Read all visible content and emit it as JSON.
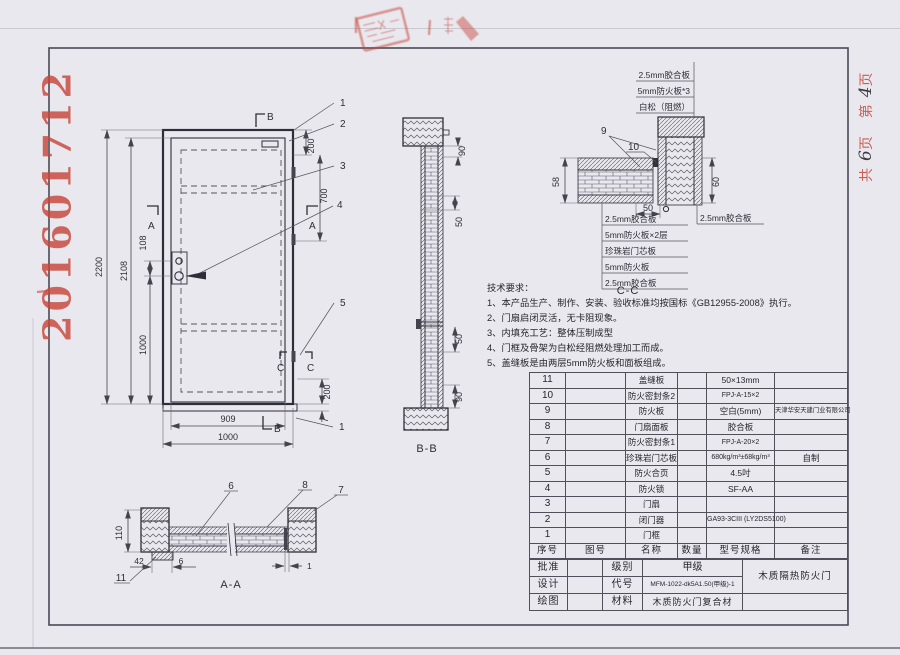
{
  "page": {
    "doc_number": "201601712",
    "sheet_note": {
      "c1": "共",
      "n1": "6",
      "c2": "页",
      "c3": "第",
      "n2": "4",
      "c4": "页"
    }
  },
  "colors": {
    "stamp_red": "#c8473a",
    "line": "#3f3f4a",
    "paper": "#e9e8ee"
  },
  "front_view": {
    "dims": {
      "total_height": "2200",
      "leaf_height": "2108",
      "lock_spacing": "108",
      "lock_to_bottom": "1000",
      "head": "200",
      "upper_side": "700",
      "lower_side": "200",
      "sill": "7",
      "leaf_width": "909",
      "frame_width": "1000",
      "edge_gap": "1"
    },
    "callouts": {
      "n1": "1",
      "n2": "2",
      "n3": "3",
      "n4": "4",
      "n5": "5"
    },
    "markers": {
      "a": "A",
      "b": "B",
      "c": "C"
    }
  },
  "section_bb": {
    "label": "B-B",
    "dims": {
      "head": "90",
      "upper": "50",
      "lower": "50",
      "bottom": "90"
    }
  },
  "detail_cc": {
    "label": "C-C",
    "dims": {
      "leaf_thickness": "58",
      "frame_thickness": "60",
      "overlap": "50"
    },
    "callouts": {
      "n9": "9",
      "n10": "10"
    },
    "top_labels": [
      "2.5mm胶合板",
      "5mm防火板*3",
      "白松（阻燃）"
    ],
    "layer_labels": [
      "2.5mm胶合板",
      "5mm防火板×2层",
      "珍珠岩门芯板",
      "5mm防火板",
      "2.5mm胶合板"
    ],
    "frame_label": "2.5mm胶合板"
  },
  "section_aa": {
    "label": "A-A",
    "dims": {
      "frame_height": "110",
      "d42": "42",
      "d6": "6",
      "d1": "1"
    },
    "callouts": {
      "n6": "6",
      "n7": "7",
      "n8": "8",
      "n11": "11"
    }
  },
  "tech_requirements": {
    "title": "技术要求：",
    "items": [
      "1、本产品生产、制作、安装、验收标准均按国标《GB12955-2008》执行。",
      "2、门扇启闭灵活，无卡阻现象。",
      "3、内填充工艺：整体压制成型",
      "4、门框及骨架为白松经阻燃处理加工而成。",
      "5、盖缝板是由两层5mm防火板和面板组成。"
    ]
  },
  "bom": {
    "headers": {
      "no": "序号",
      "fig": "图号",
      "name": "名称",
      "qty": "数量",
      "spec": "型号规格",
      "note": "备注"
    },
    "rows": [
      {
        "no": "11",
        "name": "盖缝板",
        "spec": "50×13mm",
        "note": ""
      },
      {
        "no": "10",
        "name": "防火密封条2",
        "spec": "FPJ-A-15×2",
        "note": ""
      },
      {
        "no": "9",
        "name": "防火板",
        "spec": "空白(5mm)",
        "note": "天津华安天建门业有限公司"
      },
      {
        "no": "8",
        "name": "门扇面板",
        "spec": "胶合板",
        "note": ""
      },
      {
        "no": "7",
        "name": "防火密封条1",
        "spec": "FPJ-A-20×2",
        "note": ""
      },
      {
        "no": "6",
        "name": "珍珠岩门芯板",
        "spec": "680kg/m³±68kg/m³",
        "note": "自制"
      },
      {
        "no": "5",
        "name": "防火合页",
        "spec": "4.5吋",
        "note": ""
      },
      {
        "no": "4",
        "name": "防火锁",
        "spec": "SF-AA",
        "note": ""
      },
      {
        "no": "3",
        "name": "门扇",
        "spec": "",
        "note": ""
      },
      {
        "no": "2",
        "name": "闭门器",
        "spec": "GA93-3CIII (LY2DS5100)",
        "note": ""
      },
      {
        "no": "1",
        "name": "门框",
        "spec": "",
        "note": ""
      }
    ]
  },
  "title_block": {
    "approve_label": "批准",
    "design_label": "设计",
    "draft_label": "绘图",
    "grade_label": "级别",
    "grade_value": "甲级",
    "code_label": "代号",
    "code_value": "MFM-1022-dk5A1.50(甲级)-1",
    "material_label": "材料",
    "material_value": "木质防火门复合材",
    "product_name": "木质隔热防火门"
  }
}
